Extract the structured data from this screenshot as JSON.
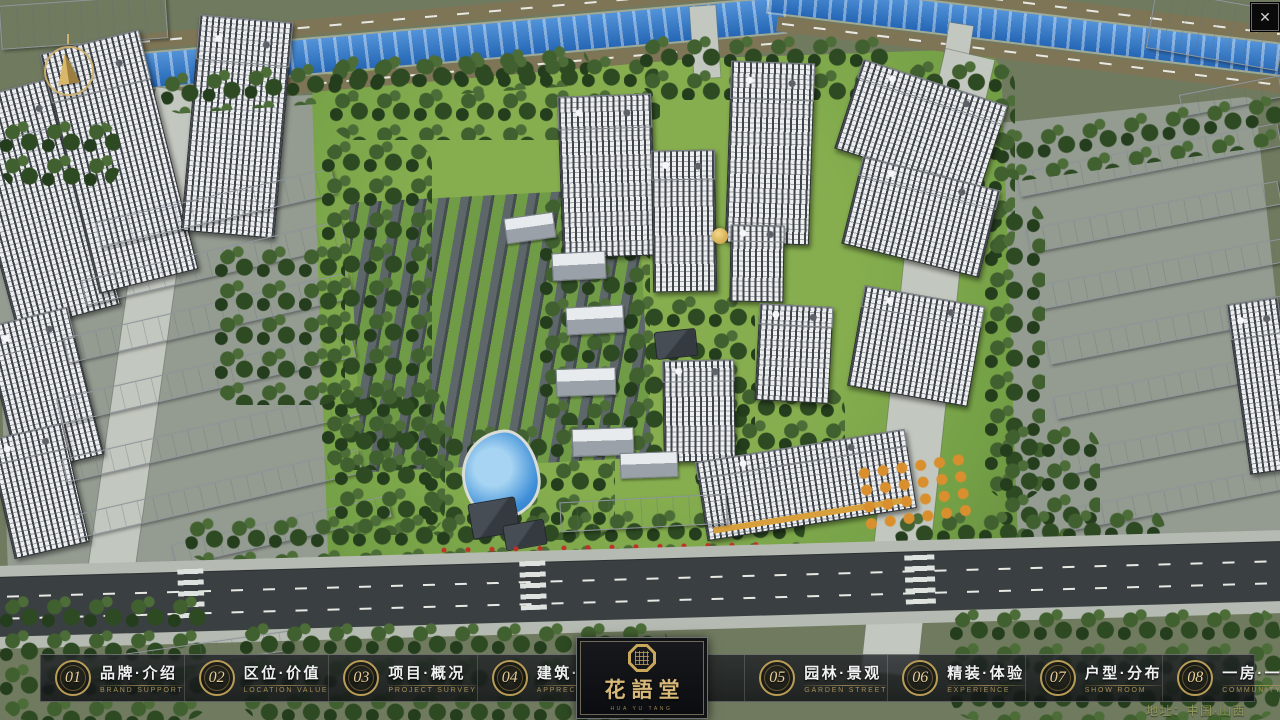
{
  "window": {
    "close_label": "✕"
  },
  "nav": {
    "items": [
      {
        "num": "01",
        "zh": "品牌·介绍",
        "en": "BRAND SUPPORT"
      },
      {
        "num": "02",
        "zh": "区位·价值",
        "en": "LOCATION VALUE"
      },
      {
        "num": "03",
        "zh": "项目·概况",
        "en": "PROJECT SURVEY"
      },
      {
        "num": "04",
        "zh": "建筑·鉴赏",
        "en": "APPRECIATION"
      },
      {
        "num": "05",
        "zh": "园林·景观",
        "en": "GARDEN STREET"
      },
      {
        "num": "06",
        "zh": "精装·体验",
        "en": "EXPERIENCE"
      },
      {
        "num": "07",
        "zh": "户型·分布",
        "en": "SHOW ROOM"
      },
      {
        "num": "08",
        "zh": "一房·一景",
        "en": "COMMUNITY"
      }
    ]
  },
  "logo": {
    "title": "花語堂",
    "subtitle": "HUA YU TANG"
  },
  "footer": {
    "address": "地址：中国·山西"
  },
  "colors": {
    "gold": "#c9a85c",
    "bar_bg": "rgba(20,22,26,0.82)",
    "river": "#2d7bd0",
    "lawn": "#7aa34a"
  }
}
